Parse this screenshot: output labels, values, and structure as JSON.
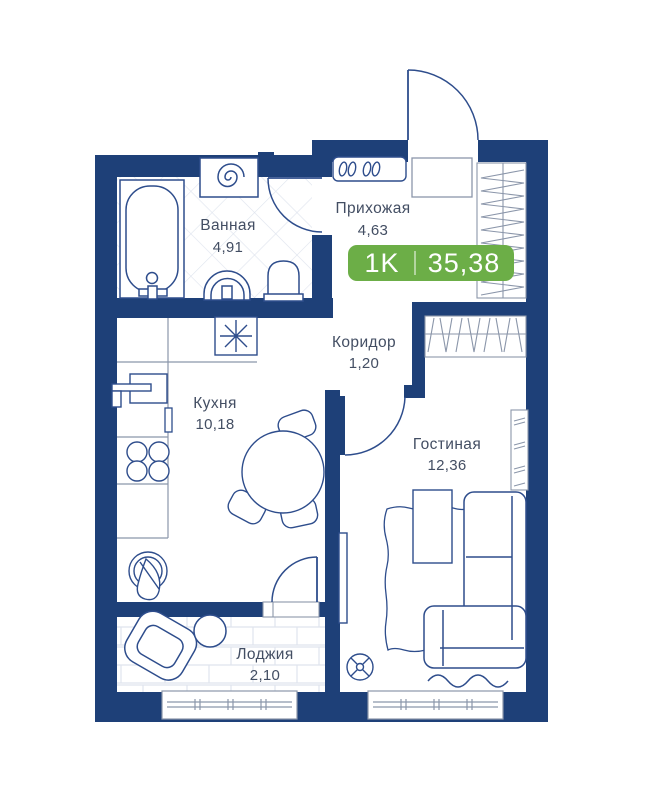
{
  "plan": {
    "title": "apartment-floor-plan",
    "badge": {
      "rooms_label": "1K",
      "total_area": "35,38"
    },
    "rooms": [
      {
        "id": "bathroom",
        "name": "Ванная",
        "area": "4,91"
      },
      {
        "id": "hallway",
        "name": "Прихожая",
        "area": "4,63"
      },
      {
        "id": "corridor",
        "name": "Коридор",
        "area": "1,20"
      },
      {
        "id": "kitchen",
        "name": "Кухня",
        "area": "10,18"
      },
      {
        "id": "living",
        "name": "Гостиная",
        "area": "12,36"
      },
      {
        "id": "loggia",
        "name": "Лоджия",
        "area": "2,10"
      }
    ],
    "colors": {
      "wall": "#1e4078",
      "accent_green": "#6cae47",
      "furniture_line": "#2e4d8c",
      "storage_line": "#8b96aa",
      "floor_pattern": "#dfe4ee",
      "label_text": "#434e63"
    }
  }
}
